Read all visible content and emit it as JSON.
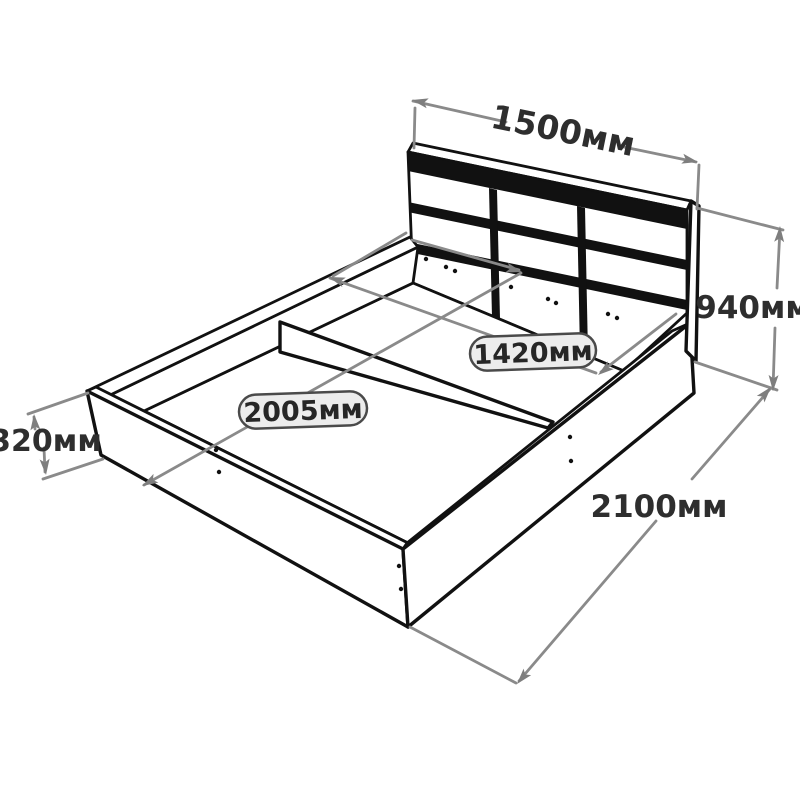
{
  "diagram": {
    "type": "furniture dimension drawing",
    "subject": "double bed with panelled headboard and storage base with center divider",
    "unit": "мм",
    "colors": {
      "background": "#ffffff",
      "outline": "#111111",
      "dimension_line": "#8a8a8a",
      "text": "#2e2e2e",
      "label_box_fill": "#ececec",
      "label_box_border": "#4a4a4a"
    }
  },
  "dimensions": {
    "headboard_width": {
      "label": "1500мм",
      "value": 1500
    },
    "overall_height": {
      "label": "940мм",
      "value": 940
    },
    "base_height": {
      "label": "320мм",
      "value": 320
    },
    "overall_length": {
      "label": "2100мм",
      "value": 2100
    },
    "inner_width": {
      "label": "1420мм",
      "value": 1420
    },
    "inner_length": {
      "label": "2005мм",
      "value": 2005
    }
  }
}
